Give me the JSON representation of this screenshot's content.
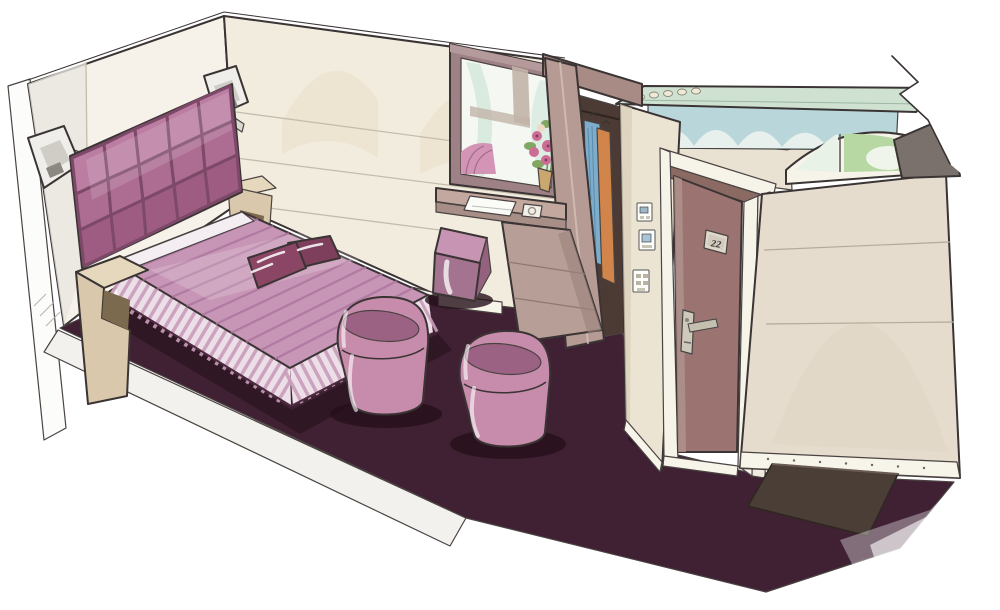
{
  "scene": {
    "elements": [
      "tufted headboard",
      "double bed with striped bedspread",
      "decorative plum cushions",
      "zigzag bedside shelf unit",
      "wall sconces",
      "window with street view",
      "flower bouquet",
      "writing ledge with notebook and dish",
      "cube pouf",
      "open wardrobe with hanging clothes",
      "light switch panels",
      "entrance door with room plate",
      "door handle with card lock",
      "bathroom block with ceiling spotlights",
      "toiletry bottles",
      "arched transom window",
      "corridor wall with baseboard",
      "dark plum carpet",
      "entry doormat",
      "two barrel armchairs"
    ]
  },
  "door": {
    "plate_number": "22"
  },
  "palette": {
    "wall_end": "#f6f2ea",
    "wall_cream": "#f2ecdf",
    "wall_arch": "#e8dbc4",
    "floor_slab": "#f3f1ed",
    "carpet": "#402134",
    "carpet_shadow": "#241019",
    "bed_pink": "#c795b5",
    "bed_stripe": "#aa739d",
    "bed_sheet": "#f4eef3",
    "skirt": "#ecdfe8",
    "skirt_stripe": "#c99cba",
    "headboard_light": "#bb7da2",
    "headboard": "#ad6c92",
    "headboard_deep": "#9e5c83",
    "headboard_dark": "#7d4968",
    "cushion": "#7e3f5c",
    "chair_pink": "#c78cab",
    "chair_inner": "#9c6284",
    "pouf_top": "#c795b3",
    "pouf_front": "#a4738f",
    "nightstand": "#d9c8ab",
    "sconce": "#efeeea",
    "window_frame": "#9d8184",
    "glass": "#f4f7f2",
    "curtain": "#c2b4a8",
    "flower_pink": "#cc6d96",
    "leaf_green": "#82a763",
    "desk": "#c2a89f",
    "desk_front": "#a78e86",
    "cabinet": "#b79e96",
    "wardrobe_interior": "#4c3a34",
    "cloth_blue": "#7dadcb",
    "cloth_orange": "#d2854a",
    "wardrobe_panel": "#b59b93",
    "wardrobe_header": "#a88b85",
    "column": "#ece4d3",
    "door": "#9b7370",
    "door_frame": "#f6f3e9",
    "door_header": "#8a6a62",
    "metal": "#cfc9bb",
    "corridor_wall": "#e5dccd",
    "baseboard": "#f7f4ea",
    "mat": "#4a3e37",
    "bath_glass_band": "#cfe2d2",
    "bath_teal": "#b9d7da",
    "arch_green": "#b7d8a2",
    "arch_pane": "#e9f2e7",
    "wedge": "#7b716c",
    "light_dot": "#efe9d6"
  }
}
